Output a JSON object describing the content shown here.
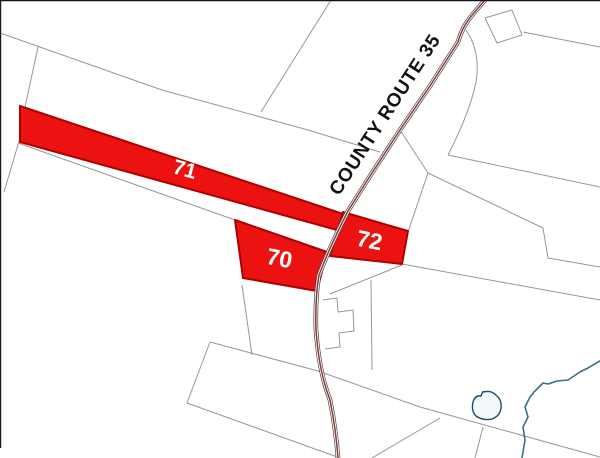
{
  "map": {
    "colors": {
      "background": "#ffffff",
      "parcel_fill": "#ed1212",
      "parcel_stroke": "#ad0000",
      "parcel_label": "#ffffff",
      "boundary": "#8b8b96",
      "road_casing": "#474747",
      "road_fill": "#ffffff",
      "road_center": "#8b3a3a",
      "road_label": "#111111",
      "water": "#35718a",
      "pond_stroke": "#1d4e66",
      "pond_fill": "#f4fafb",
      "frame": "#14141e"
    },
    "road": {
      "name": "COUNTY ROUTE 35",
      "path": "M485,0 L473,14 Q462,27 458,42 L430,86 L400,130 L370,176 L348,211 Q331,244 319,275 Q315,298 316,330 Q319,372 330,400 Q336,430 338,458",
      "label": {
        "x": 390,
        "y": 118,
        "rotation": -57,
        "font_size": 19,
        "letter_spacing": 0.6
      }
    },
    "parcels": [
      {
        "id": "71",
        "points": "20,106 346,215 337,230 20,142",
        "label": {
          "x": 183,
          "y": 176,
          "rotation": 15,
          "font_size": 21
        }
      },
      {
        "id": "70",
        "points": "235,220 327,252 317,291 243,278",
        "label": {
          "x": 278,
          "y": 266,
          "rotation": 11,
          "font_size": 23
        }
      },
      {
        "id": "72",
        "points": "343,212 408,231 402,264 330,256",
        "label": {
          "x": 368,
          "y": 248,
          "rotation": 11,
          "font_size": 23
        }
      }
    ],
    "frame": [
      {
        "x1": 0,
        "y1": 0.5,
        "x2": 600,
        "y2": 0.5
      },
      {
        "x1": 0.5,
        "y1": 0,
        "x2": 0.5,
        "y2": 448
      }
    ],
    "boundaries": [
      {
        "points": "0,33 162,90 308,130 380,152"
      },
      {
        "points": "331,0 261,112"
      },
      {
        "points": "38,47 25,107"
      },
      {
        "points": "20,138 4,192"
      },
      {
        "points": "18,143 235,220"
      },
      {
        "points": "242,285 252,355"
      },
      {
        "points": "210,342 318,371 420,407 600,457"
      },
      {
        "points": "210,342 187,403"
      },
      {
        "points": "187,403 340,458"
      },
      {
        "points": "371,280 372,370"
      },
      {
        "points": "402,264 600,300"
      },
      {
        "points": "448,155 600,187"
      },
      {
        "points": "428,173 543,228 548,258 600,267"
      },
      {
        "points": "400,130 428,173 408,232"
      },
      {
        "points": "485,18 512,10 522,35 497,43 485,18"
      },
      {
        "points": "523,32 600,47"
      },
      {
        "points": "323,300 337,298 338,312 353,310 354,331 339,333 340,347 325,349"
      },
      {
        "points": "330,294 402,265"
      },
      {
        "points": "372,458 440,418"
      },
      {
        "points": "483,427 475,458"
      }
    ],
    "curves": [
      {
        "d": "M466,30 Q481,52 476,82 Q470,112 448,155"
      }
    ],
    "water": {
      "stream": "M600,361 L588,368 L580,372 L568,380 L557,381 L548,384 L543,383 L534,392 L530,397 L525,407 L528,417 L523,427 L525,440 L522,458",
      "pond": "M484,392 Q491,390 496,395 Q502,400 501,408 Q500,416 492,419 Q483,421 476,416 Q471,411 473,402 Q475,395 481,396 Q483,390 484,392 Z"
    }
  }
}
